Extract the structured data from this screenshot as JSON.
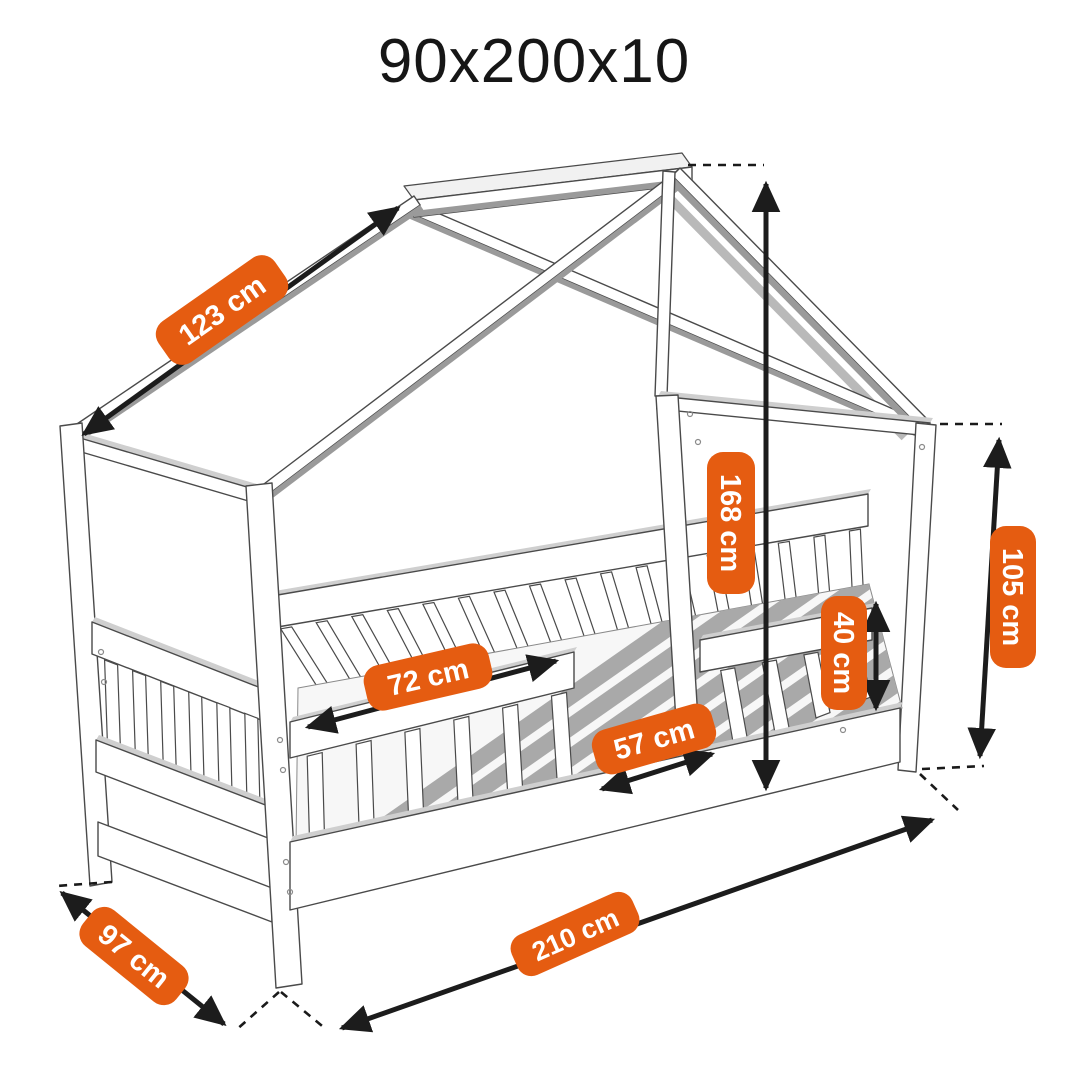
{
  "title": "90x200x10",
  "colors": {
    "accent": "#e55c11",
    "line": "#1c1c1c"
  },
  "dimensions": {
    "roof_slope": "123 cm",
    "overall_height": "168 cm",
    "wall_height": "105 cm",
    "guard_rail_height": "40 cm",
    "guard_rail_length": "72 cm",
    "entry_width": "57 cm",
    "overall_length": "210 cm",
    "overall_width": "97 cm"
  }
}
